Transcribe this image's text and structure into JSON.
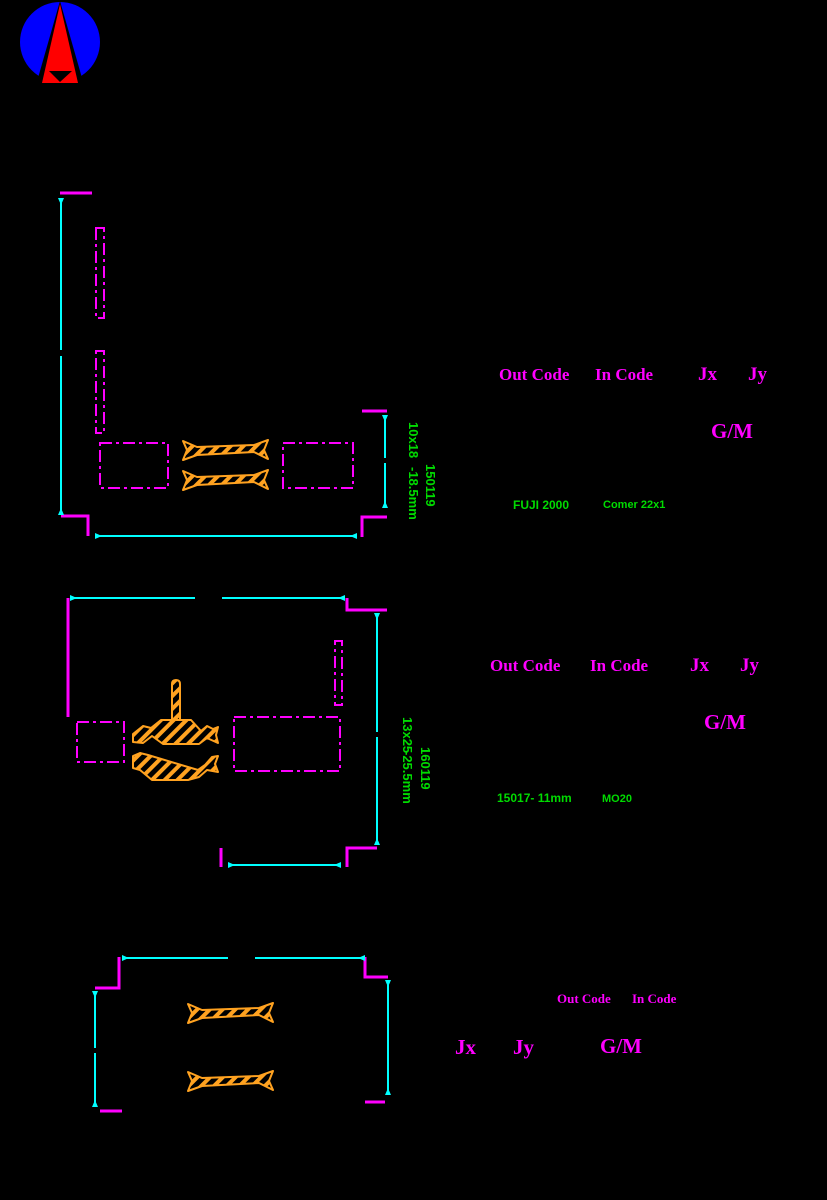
{
  "colors": {
    "background": "#000000",
    "outline_magenta": "#FF00FF",
    "dimension_cyan": "#00FFFF",
    "label_green": "#00DB00",
    "piece_orange": "#FFA220",
    "logo_blue": "#0000FF",
    "logo_red": "#FF0000"
  },
  "logo": {
    "name": "brand-logo"
  },
  "panels": [
    {
      "labels": {
        "out_code": "Out Code",
        "in_code": "In Code",
        "jx": "Jx",
        "jy": "Jy",
        "gm": "G/M"
      },
      "dims": {
        "size": "10x18",
        "offset": "-18.5mm",
        "date": "150119"
      },
      "machine": "FUJI 2000",
      "tool": "Comer 22x1"
    },
    {
      "labels": {
        "out_code": "Out Code",
        "in_code": "In Code",
        "jx": "Jx",
        "jy": "Jy",
        "gm": "G/M"
      },
      "dims": {
        "size": "13x25",
        "offset": "-25.5mm",
        "date": "160119"
      },
      "machine": "15017- 11mm",
      "tool": "MO20"
    },
    {
      "labels": {
        "out_code": "Out Code",
        "in_code": "In Code",
        "jx": "Jx",
        "jy": "Jy",
        "gm": "G/M"
      }
    }
  ]
}
